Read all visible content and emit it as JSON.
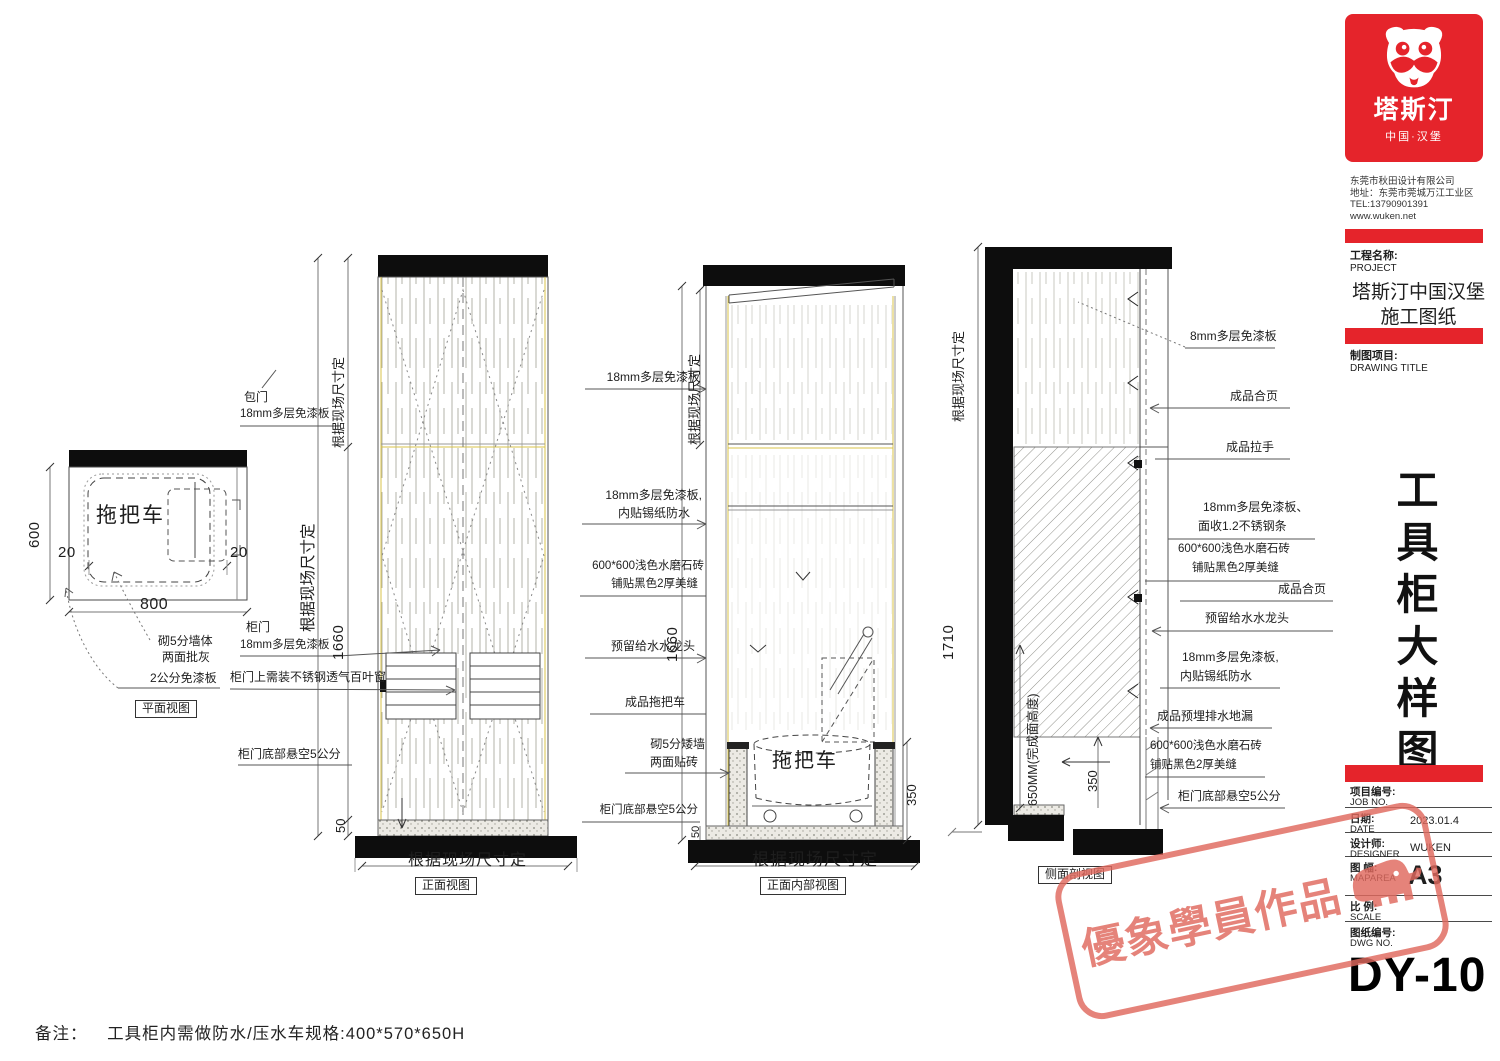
{
  "colors": {
    "brand_red": "#e5242b",
    "stamp_red": "#e0695e",
    "accent_yellow": "#d8c34a",
    "line_dark": "#2c2c2c"
  },
  "note": {
    "label": "备注：",
    "text": "工具柜内需做防水/压水车规格:400*570*650H"
  },
  "plan": {
    "caption": "平面视图",
    "item": "拖把车",
    "dim_height": "600",
    "dim_width": "800",
    "dim_left": "20",
    "dim_right": "20",
    "label_wall_1": "砌5分墙体",
    "label_wall_2": "两面批灰",
    "label_board": "2公分免漆板"
  },
  "front": {
    "caption": "正面视图",
    "dim_site_inner": "根据现场尺寸定",
    "dim_site_outer": "根据现场尺寸定",
    "dim_width": "根据现场尺寸定",
    "dim_height": "1660",
    "dim_gap": "50",
    "label_wrap_1": "包门",
    "label_wrap_2": "18mm多层免漆板",
    "label_door_1": "柜门",
    "label_door_2": "18mm多层免漆板",
    "label_vent": "柜门上需装不锈钢透气百叶窗",
    "label_gap": "柜门底部悬空5公分"
  },
  "internal": {
    "caption": "正面内部视图",
    "item": "拖把车",
    "dim_site": "根据现场尺寸定",
    "dim_width": "根据现场尺寸定",
    "dim_height": "1660",
    "dim_350": "350",
    "dim_50": "50",
    "label_top_board": "18mm多层免漆板",
    "label_liner_1": "18mm多层免漆板,",
    "label_liner_2": "内贴锡纸防水",
    "label_tile_1": "600*600浅色水磨石砖",
    "label_tile_2": "铺贴黑色2厚美缝",
    "label_tap": "预留给水水龙头",
    "label_cart": "成品拖把车",
    "label_wall_1": "砌5分矮墙",
    "label_wall_2": "两面贴砖",
    "label_gap": "柜门底部悬空5公分"
  },
  "section": {
    "caption": "侧面剖视图",
    "dim_site": "根据现场尺寸定",
    "dim_height": "1710",
    "dim_650": "650MM(完成面高度)",
    "dim_350": "350",
    "label_top": "8mm多层免漆板",
    "label_hinge_a": "成品合页",
    "label_handle": "成品拉手",
    "label_board_1a": "18mm多层免漆板、",
    "label_board_1b": "面收1.2不锈钢条",
    "label_tile_1a": "600*600浅色水磨石砖",
    "label_tile_1b": "铺贴黑色2厚美缝",
    "label_hinge_b": "成品合页",
    "label_tap": "预留给水水龙头",
    "label_board_2a": "18mm多层免漆板,",
    "label_board_2b": "内贴锡纸防水",
    "label_drain": "成品预埋排水地漏",
    "label_tile_2a": "600*600浅色水磨石砖",
    "label_tile_2b": "铺贴黑色2厚美缝",
    "label_gap": "柜门底部悬空5公分"
  },
  "titleblock": {
    "brand": "塔斯汀",
    "tagline": "中国·汉堡",
    "company_name": "东莞市秋田设计有限公司",
    "company_address": "地址：东莞市莞城万江工业区",
    "company_tel": "TEL:13790901391",
    "company_web": "www.wuken.net",
    "project_label_cn": "工程名称:",
    "project_label_en": "PROJECT",
    "project_name_1": "塔斯汀中国汉堡",
    "project_name_2": "施工图纸",
    "drawing_label_cn": "制图项目:",
    "drawing_label_en": "DRAWING TITLE",
    "sheet_title": "工具柜大样图",
    "fields": [
      {
        "cn": "项目编号:",
        "en": "JOB NO.",
        "value": ""
      },
      {
        "cn": "日期:",
        "en": "DATE",
        "value": "2023.01.4"
      },
      {
        "cn": "设计师:",
        "en": "DESIGNER",
        "value": "WUKEN"
      },
      {
        "cn": "图 幅:",
        "en": "MAPAREA",
        "value": "A3"
      },
      {
        "cn": "比 例:",
        "en": "SCALE",
        "value": ""
      },
      {
        "cn": "图纸编号:",
        "en": "DWG NO.",
        "value": ""
      }
    ],
    "dwg_no": "DY-10"
  },
  "stamp": {
    "text": "優象學員作品"
  }
}
